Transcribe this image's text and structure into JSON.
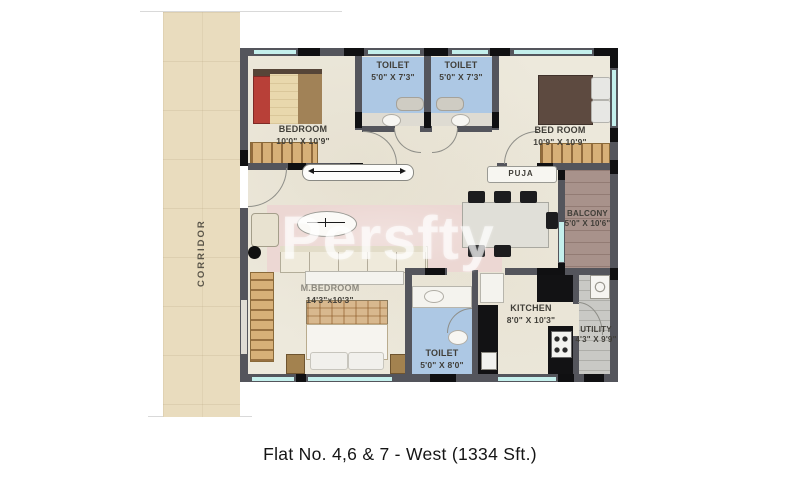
{
  "caption": "Flat No. 4,6 & 7 - West (1334 Sft.)",
  "watermark": "Persfty",
  "corridor": {
    "label": "CORRIDOR"
  },
  "rooms": {
    "bedroom1": {
      "name": "BEDROOM",
      "dims": "10'0\" X 10'9\""
    },
    "toilet1": {
      "name": "TOILET",
      "dims": "5'0\" X 7'3\""
    },
    "toilet2": {
      "name": "TOILET",
      "dims": "5'0\" X 7'3\""
    },
    "bedroom2": {
      "name": "BED ROOM",
      "dims": "10'9\" X 10'9\""
    },
    "puja": {
      "name": "PUJA"
    },
    "balcony": {
      "name": "BALCONY",
      "dims": "5'0\" X 10'6\""
    },
    "master_bedroom": {
      "name": "M.BEDROOM",
      "dims": "14'3\"x10'3\""
    },
    "toilet3": {
      "name": "TOILET",
      "dims": "5'0\" X 8'0\""
    },
    "kitchen": {
      "name": "KITCHEN",
      "dims": "8'0\" X 10'3\""
    },
    "utility": {
      "name": "UTILITY",
      "dims": "4'3\" X 9'9\""
    }
  },
  "colors": {
    "wall": "#54555c",
    "window_glass": "#c4efec",
    "toilet_floor": "#adc8e4",
    "balcony_floor": "#a8928b",
    "utility_floor": "#c9c9c5",
    "corridor_floor": "#e9dcbe",
    "plan_floor": "#ede9dc",
    "bed_accent_red": "#b84038",
    "wood": "#d7b078"
  }
}
